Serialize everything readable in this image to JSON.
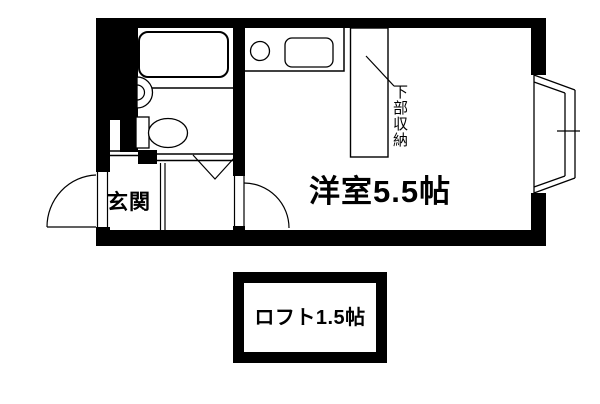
{
  "floor_plan": {
    "labels": {
      "main_room": "洋室5.5帖",
      "entrance": "玄関",
      "under_storage": "下部収納",
      "loft": "ロフト1.5帖"
    },
    "colors": {
      "wall": "#000000",
      "line": "#000000",
      "background": "#ffffff",
      "text": "#000000"
    }
  }
}
